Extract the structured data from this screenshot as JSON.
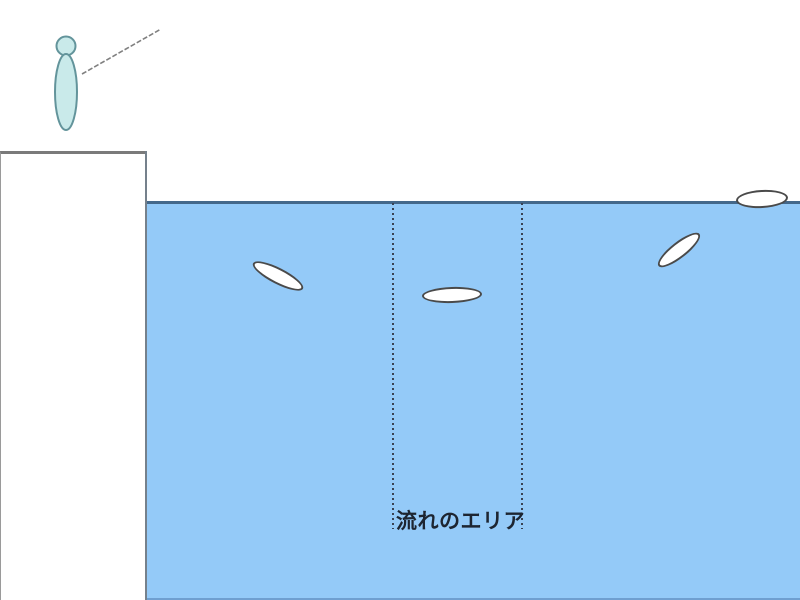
{
  "labels": {
    "flow_area": "流れのエリア"
  },
  "icons": {
    "angler_figure": "person standing on shore",
    "fishing_rod_line": "cast line from angler toward water",
    "float_marker": "white oval fishing float"
  },
  "colors": {
    "water": "#94caf8",
    "water_line": "#44688a",
    "water_bottom_line": "#6f9fd0",
    "land_line": "#7a7a7a",
    "edge_line": "#75818c",
    "person_fill": "#c9eaea",
    "person_stroke": "#63949b",
    "rod_line": "#808080",
    "float_fill": "#ffffff",
    "float_stroke": "#4a4a4a",
    "dotted_line": "#394253",
    "label_text": "#1d2531"
  },
  "floats": [
    {
      "x": 278,
      "y": 276,
      "rx": 28,
      "ry": 8,
      "angle": 27
    },
    {
      "x": 452,
      "y": 295,
      "rx": 30,
      "ry": 8,
      "angle": -2
    },
    {
      "x": 679,
      "y": 250,
      "rx": 26,
      "ry": 8,
      "angle": -38
    },
    {
      "x": 762,
      "y": 199,
      "rx": 26,
      "ry": 9,
      "angle": -3
    }
  ]
}
